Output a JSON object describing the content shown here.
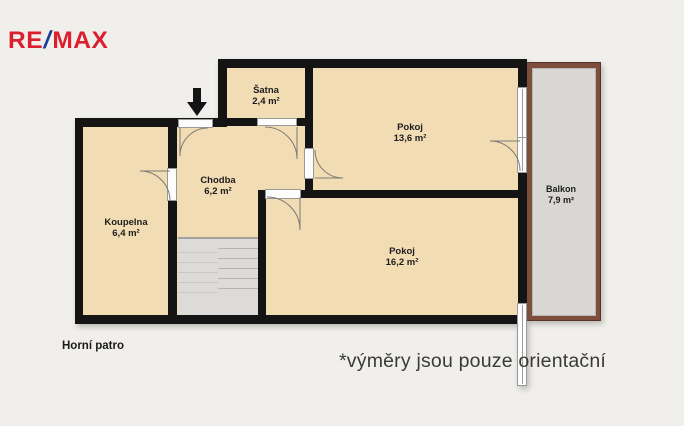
{
  "brand": {
    "re": "RE",
    "slash": "/",
    "max": "MAX",
    "red": "#dc1f2e",
    "blue": "#1b3f94"
  },
  "rooms": {
    "satna": {
      "name": "Šatna",
      "area": "2,4 m²"
    },
    "pokoj_horni": {
      "name": "Pokoj",
      "area": "13,6 m²"
    },
    "chodba": {
      "name": "Chodba",
      "area": "6,2 m²"
    },
    "koupelna": {
      "name": "Koupelna",
      "area": "6,4 m²"
    },
    "pokoj_dolni": {
      "name": "Pokoj",
      "area": "16,2 m²"
    },
    "balkon": {
      "name": "Balkon",
      "area": "7,9 m²"
    }
  },
  "floor_label": "Horní patro",
  "disclaimer": "*výměry jsou pouze orientační",
  "colors": {
    "background": "#f0efeb",
    "room_fill": "#f2dcb4",
    "wall": "#141414",
    "balcony_fill": "#d8d7d4",
    "balcony_border": "#7c4e3b",
    "stairs_fill": "#dcdbd8"
  }
}
